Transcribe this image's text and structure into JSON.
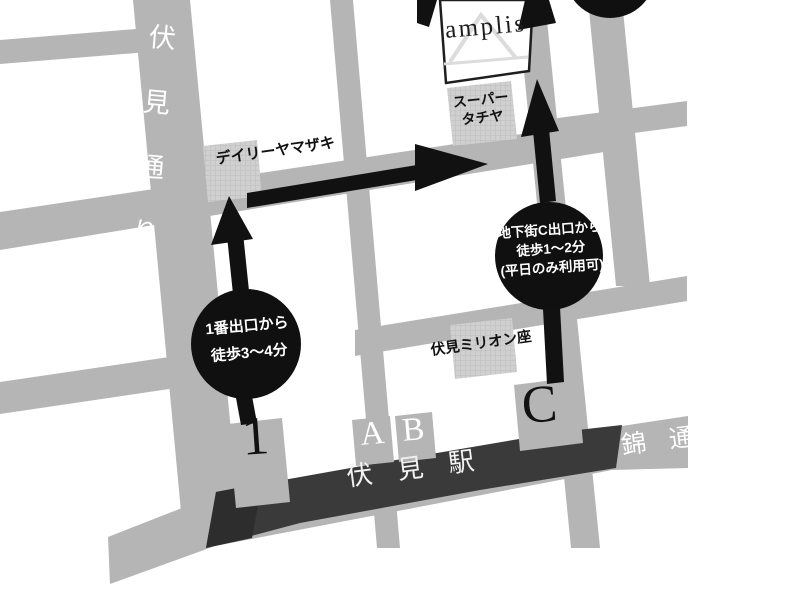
{
  "map": {
    "colors": {
      "background": "#ffffff",
      "road": "#b5b5b5",
      "building_fill": "#d0d0d0",
      "building_hatch": "#bdbdbd",
      "station_band": "#3a3a3a",
      "station_tip": "#2d2d2d",
      "marker_black": "#101010",
      "arrow_black": "#111111",
      "logo_box_fill": "#ffffff",
      "logo_box_border": "#1e1e1e",
      "logo_watermark": "#dcdcdc",
      "text_dark": "#111111",
      "text_light": "#ffffff"
    },
    "destination": {
      "logo": "amplis"
    },
    "streets": {
      "fushimi_dori": "伏見通り",
      "fushimi_dori_chars": [
        "伏",
        "見",
        "通",
        "り"
      ],
      "nishiki_dori": "錦 通"
    },
    "station": {
      "name": "伏 見 駅",
      "exits": {
        "exit1": "1",
        "exitA": "A",
        "exitB": "B",
        "exitC": "C"
      }
    },
    "landmarks": {
      "daily_yamazaki": "デイリーヤマザキ",
      "super_tachiya_line1": "スーパー",
      "super_tachiya_line2": "タチヤ",
      "fushimi_million_za": "伏見ミリオン座"
    },
    "notes": {
      "exit1": {
        "line1": "1番出口から",
        "line2": "徒歩3〜4分"
      },
      "exitC": {
        "line1": "地下街C出口から",
        "line2": "徒歩1〜2分",
        "line3": "(平日のみ利用可)"
      }
    }
  }
}
